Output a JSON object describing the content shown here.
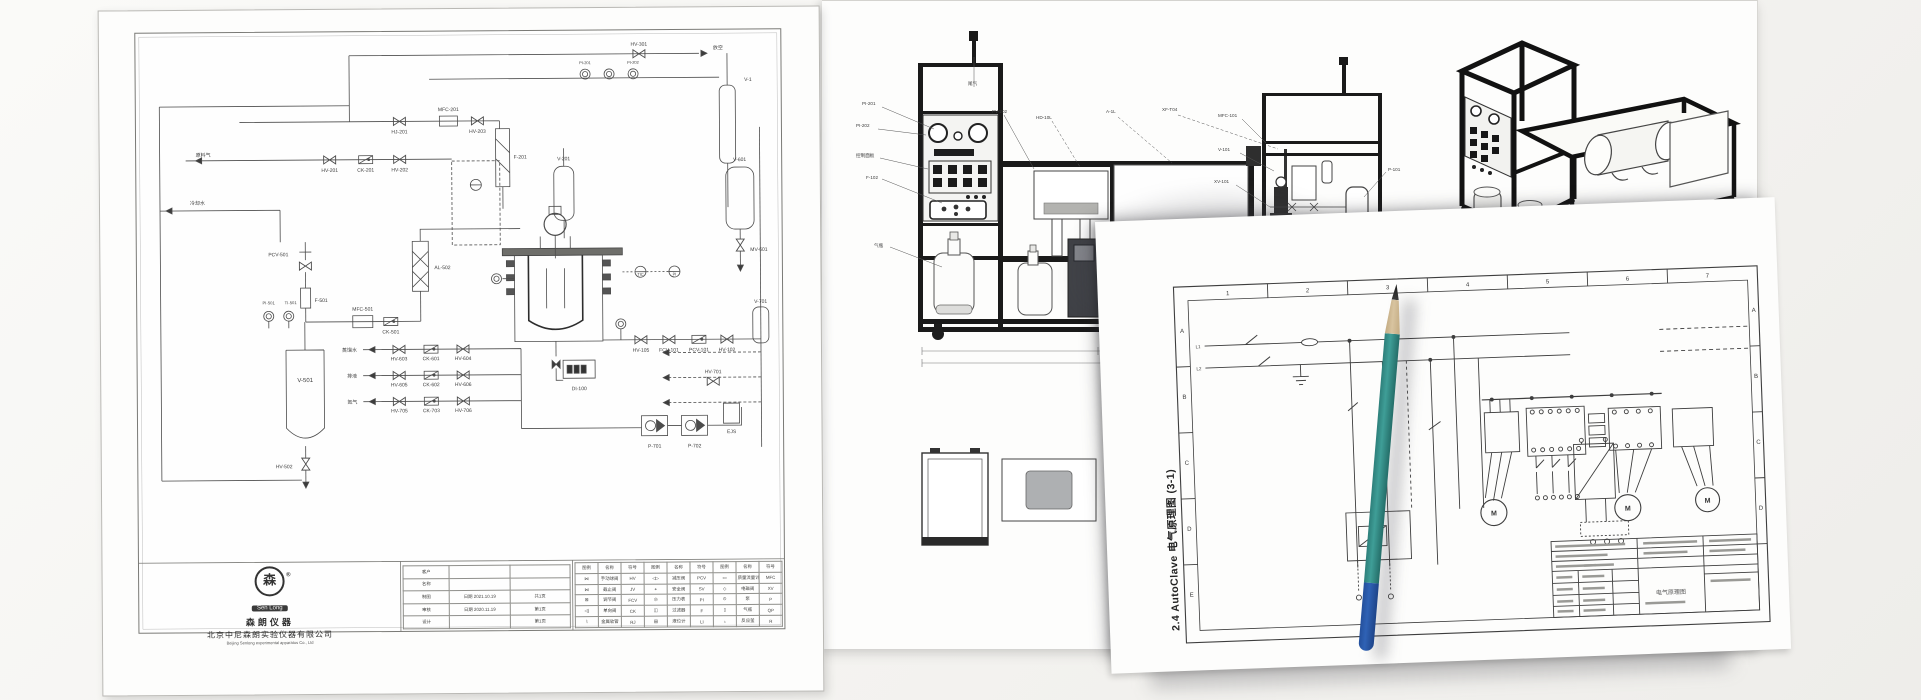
{
  "photo": {
    "background": "#f4f3f0"
  },
  "pencil": {
    "tip_color": "#1c1c1c",
    "wood_color": "#d8c4a0",
    "body_color": "#3f9e97",
    "cap_color": "#2f62b5"
  },
  "pid": {
    "logo": {
      "brand_en": "Sen Long",
      "brand_cn": "森朗仪器",
      "reg": "®",
      "badge_glyph": "森"
    },
    "company_cn": "北京中尼森朗实验仪器有限公司",
    "company_en": "Beijing Senlong experimental apparatus Co., Ltd",
    "title_block": {
      "rows": [
        {
          "label": "客户",
          "value": "",
          "page": ""
        },
        {
          "label": "名称",
          "value": "",
          "page": ""
        },
        {
          "label": "制图",
          "value": "日期 2021.10.19",
          "page": "共1页"
        },
        {
          "label": "审核",
          "value": "日期 2020.11.19",
          "page": "第1页"
        },
        {
          "label": "设计",
          "value": "",
          "page": "第1页"
        }
      ]
    },
    "legend": {
      "headers": [
        "图例",
        "名称",
        "符号",
        "图例",
        "名称",
        "符号",
        "图例",
        "名称",
        "符号"
      ],
      "rows": [
        [
          "⋈",
          "手动球阀",
          "HV",
          "◁▷",
          "减压阀",
          "PCV",
          "▭",
          "质量流量计",
          "MFC"
        ],
        [
          "⋈",
          "截止阀",
          "JV",
          "⌖",
          "安全阀",
          "SV",
          "◇",
          "电磁阀",
          "XV"
        ],
        [
          "⊠",
          "调节阀",
          "FCV",
          "◎",
          "压力表",
          "PI",
          "⊙",
          "泵",
          "P"
        ],
        [
          "◁|",
          "单向阀",
          "CK",
          "◫",
          "过滤器",
          "F",
          "▯",
          "气瓶",
          "QP"
        ],
        [
          "⌇",
          "金属软管",
          "RJ",
          "▤",
          "液位计",
          "LI",
          "♁",
          "反应釜",
          "R"
        ]
      ]
    },
    "labels": [
      {
        "t": "HV-301",
        "x": 540,
        "y": 38,
        "a": "middle"
      },
      {
        "t": "放空",
        "x": 614,
        "y": 42
      },
      {
        "t": "V-1",
        "x": 645,
        "y": 74
      },
      {
        "t": "PI-201",
        "x": 486,
        "y": 56,
        "a": "middle",
        "s": 4
      },
      {
        "t": "PI-202",
        "x": 534,
        "y": 56,
        "a": "middle",
        "s": 4
      },
      {
        "t": "原料气",
        "x": 96,
        "y": 146
      },
      {
        "t": "HJ-201",
        "x": 300,
        "y": 124,
        "a": "middle"
      },
      {
        "t": "MFC-201",
        "x": 349,
        "y": 102,
        "a": "middle"
      },
      {
        "t": "HV-203",
        "x": 378,
        "y": 124,
        "a": "middle"
      },
      {
        "t": "HV-201",
        "x": 230,
        "y": 162,
        "a": "middle"
      },
      {
        "t": "CK-201",
        "x": 266,
        "y": 162,
        "a": "middle"
      },
      {
        "t": "HV-202",
        "x": 300,
        "y": 162,
        "a": "middle"
      },
      {
        "t": "F-201",
        "x": 414,
        "y": 150
      },
      {
        "t": "V-201",
        "x": 464,
        "y": 152,
        "a": "middle"
      },
      {
        "t": "V-601",
        "x": 640,
        "y": 154,
        "a": "middle"
      },
      {
        "t": "MV-601",
        "x": 650,
        "y": 244
      },
      {
        "t": "冷却水",
        "x": 90,
        "y": 194
      },
      {
        "t": "PCV-501",
        "x": 168,
        "y": 246
      },
      {
        "t": "F-501",
        "x": 214,
        "y": 292
      },
      {
        "t": "MFC-501",
        "x": 262,
        "y": 301,
        "a": "middle"
      },
      {
        "t": "CK-501",
        "x": 290,
        "y": 324,
        "a": "middle"
      },
      {
        "t": "AL-502",
        "x": 334,
        "y": 260
      },
      {
        "t": "PI-501",
        "x": 168,
        "y": 294,
        "a": "middle",
        "s": 4.2
      },
      {
        "t": "TI-501",
        "x": 190,
        "y": 294,
        "a": "middle",
        "s": 4.2
      },
      {
        "t": "V-501",
        "x": 204,
        "y": 372,
        "a": "middle",
        "s": 6
      },
      {
        "t": "HV-502",
        "x": 174,
        "y": 458
      },
      {
        "t": "TIC",
        "x": 540,
        "y": 268,
        "a": "middle",
        "s": 4
      },
      {
        "t": "PI",
        "x": 574,
        "y": 268,
        "a": "middle",
        "s": 4
      },
      {
        "t": "HV-105",
        "x": 540,
        "y": 344,
        "a": "middle"
      },
      {
        "t": "FCV-101",
        "x": 568,
        "y": 344,
        "a": "middle"
      },
      {
        "t": "PCV-101",
        "x": 598,
        "y": 344,
        "a": "middle"
      },
      {
        "t": "HV-102",
        "x": 626,
        "y": 344,
        "a": "middle"
      },
      {
        "t": "DI-100",
        "x": 478,
        "y": 382,
        "a": "middle"
      },
      {
        "t": "蒸馏水",
        "x": 256,
        "y": 342,
        "a": "end"
      },
      {
        "t": "排液",
        "x": 256,
        "y": 368,
        "a": "end"
      },
      {
        "t": "氮气",
        "x": 256,
        "y": 394,
        "a": "end"
      },
      {
        "t": "HV-603",
        "x": 298,
        "y": 351,
        "a": "middle"
      },
      {
        "t": "CK-601",
        "x": 330,
        "y": 351,
        "a": "middle"
      },
      {
        "t": "HV-604",
        "x": 362,
        "y": 351,
        "a": "middle"
      },
      {
        "t": "HV-605",
        "x": 298,
        "y": 377,
        "a": "middle"
      },
      {
        "t": "CK-602",
        "x": 330,
        "y": 377,
        "a": "middle"
      },
      {
        "t": "HV-606",
        "x": 362,
        "y": 377,
        "a": "middle"
      },
      {
        "t": "HV-705",
        "x": 298,
        "y": 403,
        "a": "middle"
      },
      {
        "t": "CK-703",
        "x": 330,
        "y": 403,
        "a": "middle"
      },
      {
        "t": "HV-706",
        "x": 362,
        "y": 403,
        "a": "middle"
      },
      {
        "t": "P-701",
        "x": 553,
        "y": 440,
        "a": "middle"
      },
      {
        "t": "P-702",
        "x": 593,
        "y": 440,
        "a": "middle"
      },
      {
        "t": "HV-701",
        "x": 612,
        "y": 366,
        "a": "middle"
      },
      {
        "t": "V-701",
        "x": 660,
        "y": 296,
        "a": "middle"
      },
      {
        "t": "EJS",
        "x": 630,
        "y": 426,
        "a": "middle"
      }
    ]
  },
  "elevation": {
    "labels": [
      {
        "t": "PI-201",
        "x": 40,
        "y": 104
      },
      {
        "t": "PI-202",
        "x": 34,
        "y": 126
      },
      {
        "t": "控制面板",
        "x": 34,
        "y": 156
      },
      {
        "t": "F-102",
        "x": 44,
        "y": 178
      },
      {
        "t": "气瓶",
        "x": 52,
        "y": 246
      },
      {
        "t": "尾气",
        "x": 146,
        "y": 84
      },
      {
        "t": "PV-202",
        "x": 170,
        "y": 112
      },
      {
        "t": "HD-10L",
        "x": 214,
        "y": 118
      },
      {
        "t": "A-1L",
        "x": 284,
        "y": 112
      },
      {
        "t": "XF-T04",
        "x": 340,
        "y": 110
      },
      {
        "t": "MFC-101",
        "x": 396,
        "y": 116
      },
      {
        "t": "V-101",
        "x": 396,
        "y": 150
      },
      {
        "t": "XV-101",
        "x": 392,
        "y": 182
      },
      {
        "t": "P-101",
        "x": 566,
        "y": 170
      },
      {
        "t": "V-102",
        "x": 566,
        "y": 220
      }
    ]
  },
  "electrical": {
    "caption": "2.4 AutoClave 电气原理图 (3-1)",
    "column_numbers": [
      "1",
      "2",
      "3",
      "4",
      "5",
      "6",
      "7"
    ],
    "row_letters": [
      "A",
      "B",
      "C",
      "D",
      "E"
    ],
    "labels": [
      {
        "t": "1",
        "x": 130,
        "y": 78,
        "a": "middle",
        "s": 6
      },
      {
        "t": "2",
        "x": 210,
        "y": 78,
        "a": "middle",
        "s": 6
      },
      {
        "t": "3",
        "x": 290,
        "y": 78,
        "a": "middle",
        "s": 6
      },
      {
        "t": "4",
        "x": 370,
        "y": 78,
        "a": "middle",
        "s": 6
      },
      {
        "t": "5",
        "x": 450,
        "y": 78,
        "a": "middle",
        "s": 6
      },
      {
        "t": "6",
        "x": 530,
        "y": 78,
        "a": "middle",
        "s": 6
      },
      {
        "t": "7",
        "x": 610,
        "y": 78,
        "a": "middle",
        "s": 6
      },
      {
        "t": "A",
        "x": 83,
        "y": 114,
        "a": "middle",
        "s": 6
      },
      {
        "t": "B",
        "x": 83,
        "y": 180,
        "a": "middle",
        "s": 6
      },
      {
        "t": "C",
        "x": 83,
        "y": 246,
        "a": "middle",
        "s": 6
      },
      {
        "t": "D",
        "x": 83,
        "y": 312,
        "a": "middle",
        "s": 6
      },
      {
        "t": "E",
        "x": 83,
        "y": 378,
        "a": "middle",
        "s": 6
      },
      {
        "t": "A",
        "x": 655,
        "y": 114,
        "a": "middle",
        "s": 6
      },
      {
        "t": "B",
        "x": 655,
        "y": 180,
        "a": "middle",
        "s": 6
      },
      {
        "t": "C",
        "x": 655,
        "y": 246,
        "a": "middle",
        "s": 6
      },
      {
        "t": "D",
        "x": 655,
        "y": 312,
        "a": "middle",
        "s": 6
      },
      {
        "t": "L1",
        "x": 101,
        "y": 130,
        "a": "end",
        "s": 4.5
      },
      {
        "t": "L2",
        "x": 101,
        "y": 152,
        "a": "end",
        "s": 4.5
      },
      {
        "t": "M",
        "x": 388,
        "y": 308,
        "a": "middle",
        "s": 7,
        "b": 1
      },
      {
        "t": "M",
        "x": 522,
        "y": 308,
        "a": "middle",
        "s": 7,
        "b": 1
      },
      {
        "t": "M",
        "x": 602,
        "y": 303,
        "a": "middle",
        "s": 7,
        "b": 1
      },
      {
        "t": "电气原理图",
        "x": 562,
        "y": 393,
        "a": "middle",
        "s": 6,
        "c": "#555"
      }
    ]
  }
}
